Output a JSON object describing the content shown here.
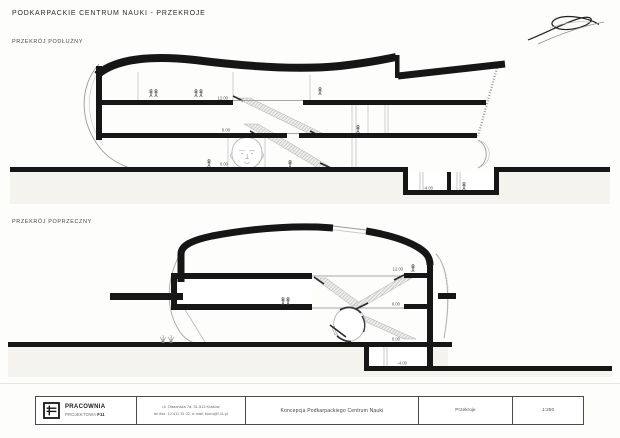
{
  "page": {
    "title": "PODKARPACKIE CENTRUM NAUKI - PRZEKROJE"
  },
  "sections": [
    {
      "label": "PRZEKRÓJ PODŁUŻNY",
      "levels": {
        "upper_floor": "12.00",
        "first_floor": "6.00",
        "ground": "0.00",
        "basement": "-4.00"
      }
    },
    {
      "label": "PRZEKRÓJ POPRZECZNY",
      "levels": {
        "upper_floor": "12.00",
        "first_floor": "6.00",
        "ground": "0.00",
        "basement": "-4.00"
      }
    }
  ],
  "title_block": {
    "company_name_line1": "PRACOWNIA",
    "company_name_line2_regular": "PROJEKTOWA ",
    "company_name_line2_bold": "F11",
    "address_line1": "ul. Olszańska 7a, 31-513 Kraków",
    "address_line2": "tel./fax. 12 411 31 02, e-mail: biuro@f-11.pl",
    "project_title": "Koncepcja Podkarpackiego Centrum Nauki",
    "drawing_title": "Przekroje",
    "scale": "1:250"
  },
  "colors": {
    "ink": "#161616",
    "sketch_line": "#aaaaaa",
    "ground_tint": "#f4f3ee"
  }
}
